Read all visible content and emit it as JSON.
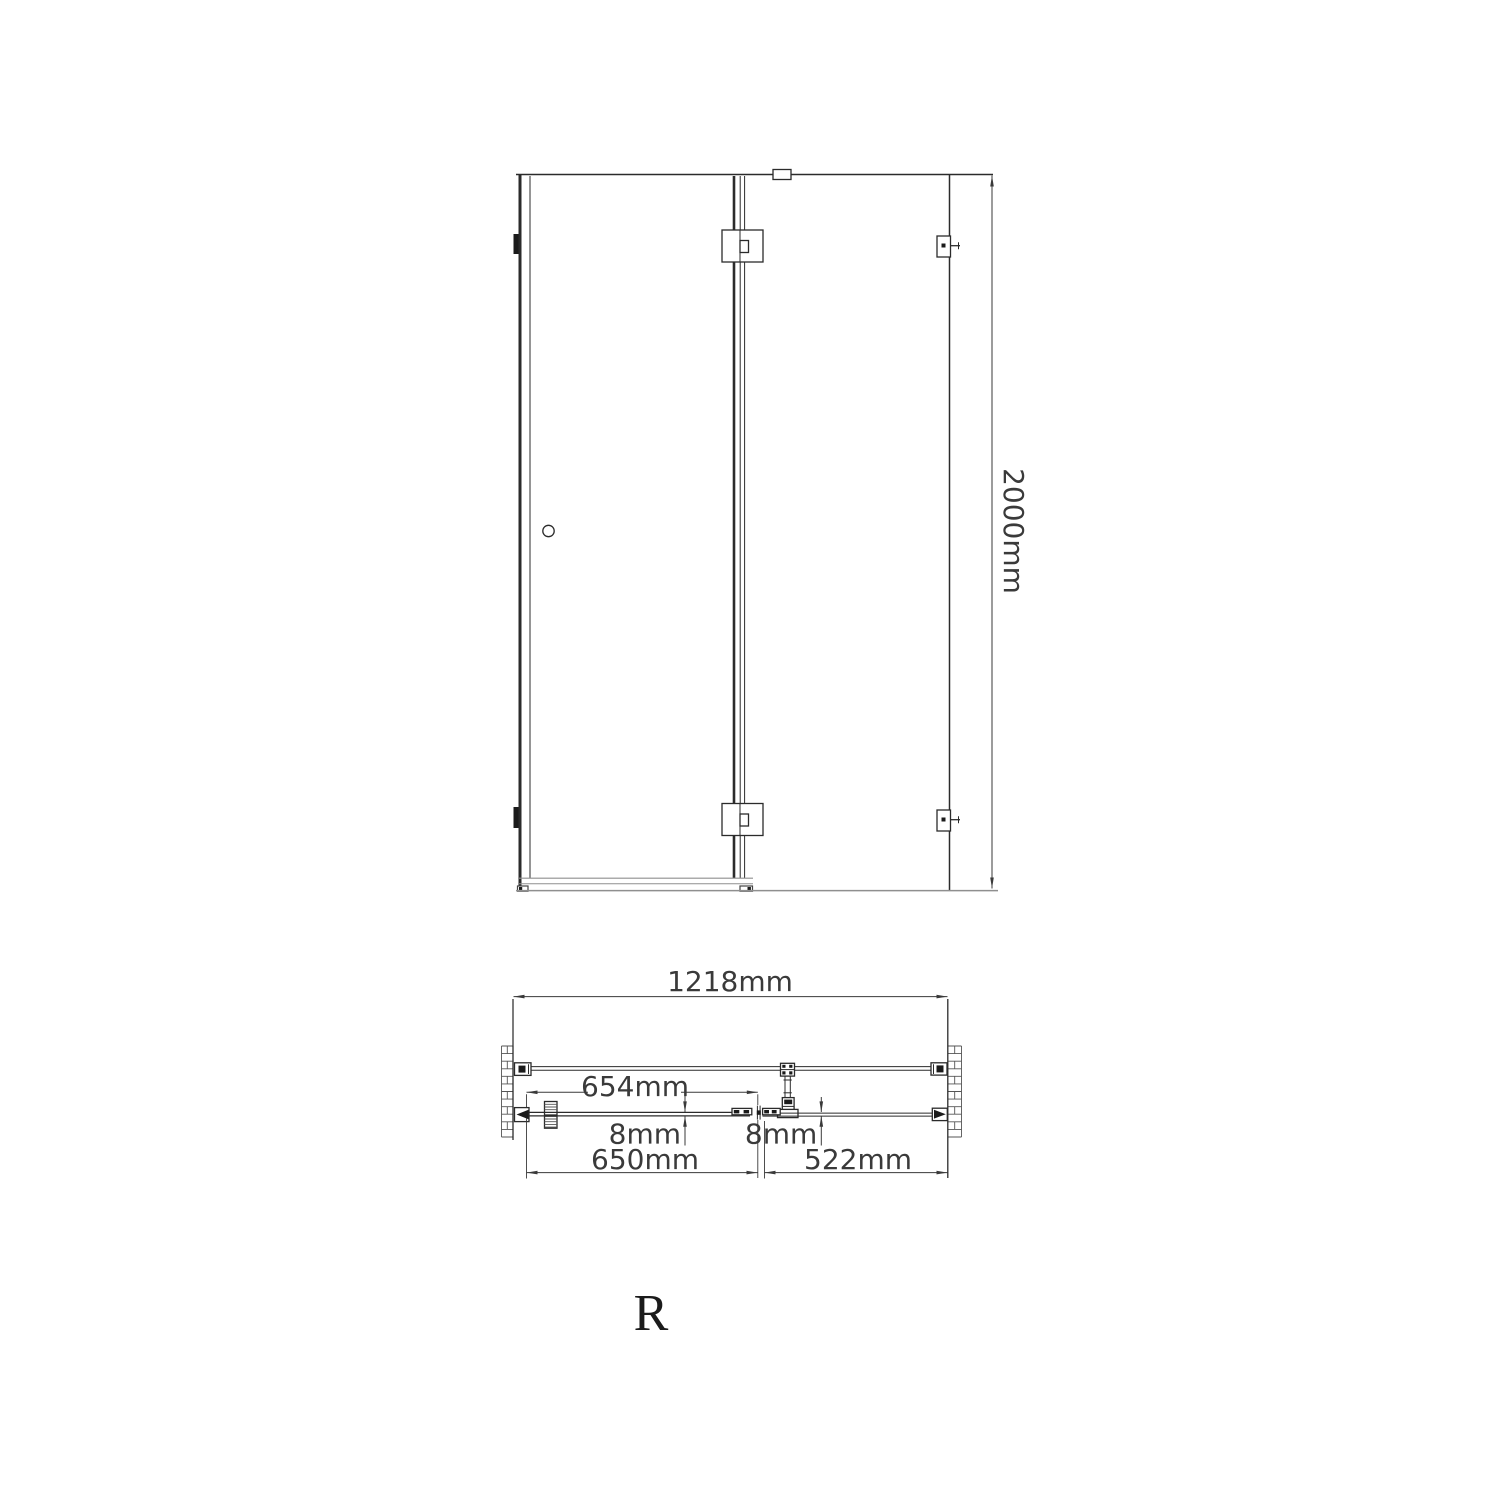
{
  "colors": {
    "background": "#ffffff",
    "line": "#2b2b2b",
    "dimension": "#3a3a3a",
    "light_line": "#8f8f8f"
  },
  "labels": {
    "height": "2000mm",
    "total_width": "1218mm",
    "door_glass_width": "654mm",
    "glass_thickness_door": "8mm",
    "glass_thickness_panel": "8mm",
    "door_width": "650mm",
    "panel_width": "522mm",
    "orientation": "R"
  }
}
